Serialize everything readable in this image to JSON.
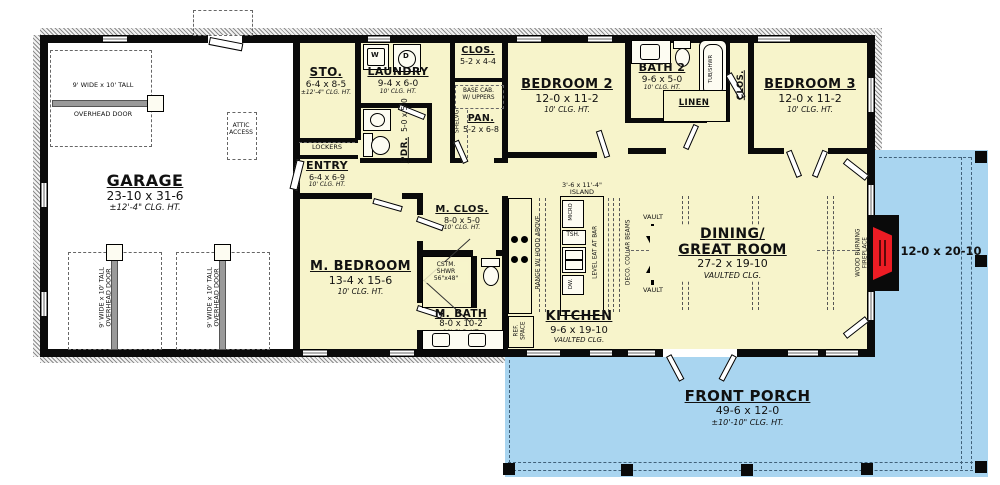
{
  "colors": {
    "room_fill": "#f7f4cb",
    "porch_fill": "#a9d5f0",
    "fireplace_red": "#ed1c24",
    "wall": "#0a0a0a"
  },
  "rooms": {
    "garage": {
      "name": "GARAGE",
      "dims": "23-10 x 31-6",
      "ceil": "±12'-4\" CLG. HT."
    },
    "sto": {
      "name": "STO.",
      "dims": "6-4 x 8-5",
      "ceil": "±12'-4\" CLG. HT."
    },
    "laundry": {
      "name": "LAUNDRY",
      "dims": "9-4 x 6-0",
      "ceil": "10' CLG. HT."
    },
    "pdr": {
      "name": "PDR.",
      "dims": "5-0 x 5-0"
    },
    "entry": {
      "name": "ENTRY",
      "dims": "6-4 x 6-9",
      "ceil": "10' CLG. HT."
    },
    "closet_hall": {
      "name": "CLOS.",
      "dims": "5-2 x 4-4"
    },
    "pantry": {
      "name": "PAN.",
      "dims": "5-2 x 6-8"
    },
    "bedroom2": {
      "name": "BEDROOM 2",
      "dims": "12-0 x 11-2",
      "ceil": "10' CLG. HT."
    },
    "bath2": {
      "name": "BATH 2",
      "dims": "9-6 x 5-0",
      "ceil": "10' CLG. HT."
    },
    "linen": {
      "name": "LINEN"
    },
    "closet_b3": {
      "name": "CLOS."
    },
    "bedroom3": {
      "name": "BEDROOM 3",
      "dims": "12-0 x 11-2",
      "ceil": "10' CLG. HT."
    },
    "m_bedroom": {
      "name": "M. BEDROOM",
      "dims": "13-4 x 15-6",
      "ceil": "10' CLG. HT."
    },
    "m_closet": {
      "name": "M. CLOS.",
      "dims": "8-0 x 5-0",
      "ceil": "10' CLG. HT."
    },
    "m_bath": {
      "name": "M. BATH",
      "dims": "8-0 x 10-2",
      "ceil": "10' CLG. HT."
    },
    "kitchen": {
      "name": "KITCHEN",
      "dims": "9-6 x 19-10",
      "ceil": "VAULTED CLG."
    },
    "great_room": {
      "name_line1": "DINING/",
      "name_line2": "GREAT ROOM",
      "dims": "27-2 x 19-10",
      "ceil": "VAULTED CLG."
    },
    "front_porch": {
      "name": "FRONT PORCH",
      "dims": "49-6 x 12-0",
      "ceil": "±10'-10\" CLG. HT."
    },
    "side_porch": {
      "dims": "12-0 x 20-10"
    }
  },
  "annotations": {
    "overhead_door_line1": "9' WIDE x 10' TALL",
    "overhead_door_line2": "OVERHEAD DOOR",
    "attic_line1": "ATTIC",
    "attic_line2": "ACCESS",
    "lockers": "LOCKERS",
    "base_cab_line1": "BASE CAB.",
    "base_cab_line2": "W/ UPPERS",
    "shelving": "SHELVG.",
    "tub_shower": "TUB/SHWR",
    "washer": "W",
    "dryer": "D",
    "custom_shower_line1": "CSTM.",
    "custom_shower_line2": "SHWR",
    "custom_shower_line3": "56\"x48\"",
    "island_line1": "3'-6 x 11'-4\"",
    "island_line2": "ISLAND",
    "micro": "MICRO",
    "trash": "TSH.",
    "dishwasher": "DW.",
    "eat_bar": "LEVEL EAT AT BAR",
    "range": "RANGE W/ HOOD ABOVE",
    "ref_line1": "REF.",
    "ref_line2": "SPACE",
    "collar_beams": "DECO. COLLAR BEAMS",
    "vault": "VAULT",
    "fireplace_line1": "WOOD BURNING",
    "fireplace_line2": "FIREPLACE"
  }
}
